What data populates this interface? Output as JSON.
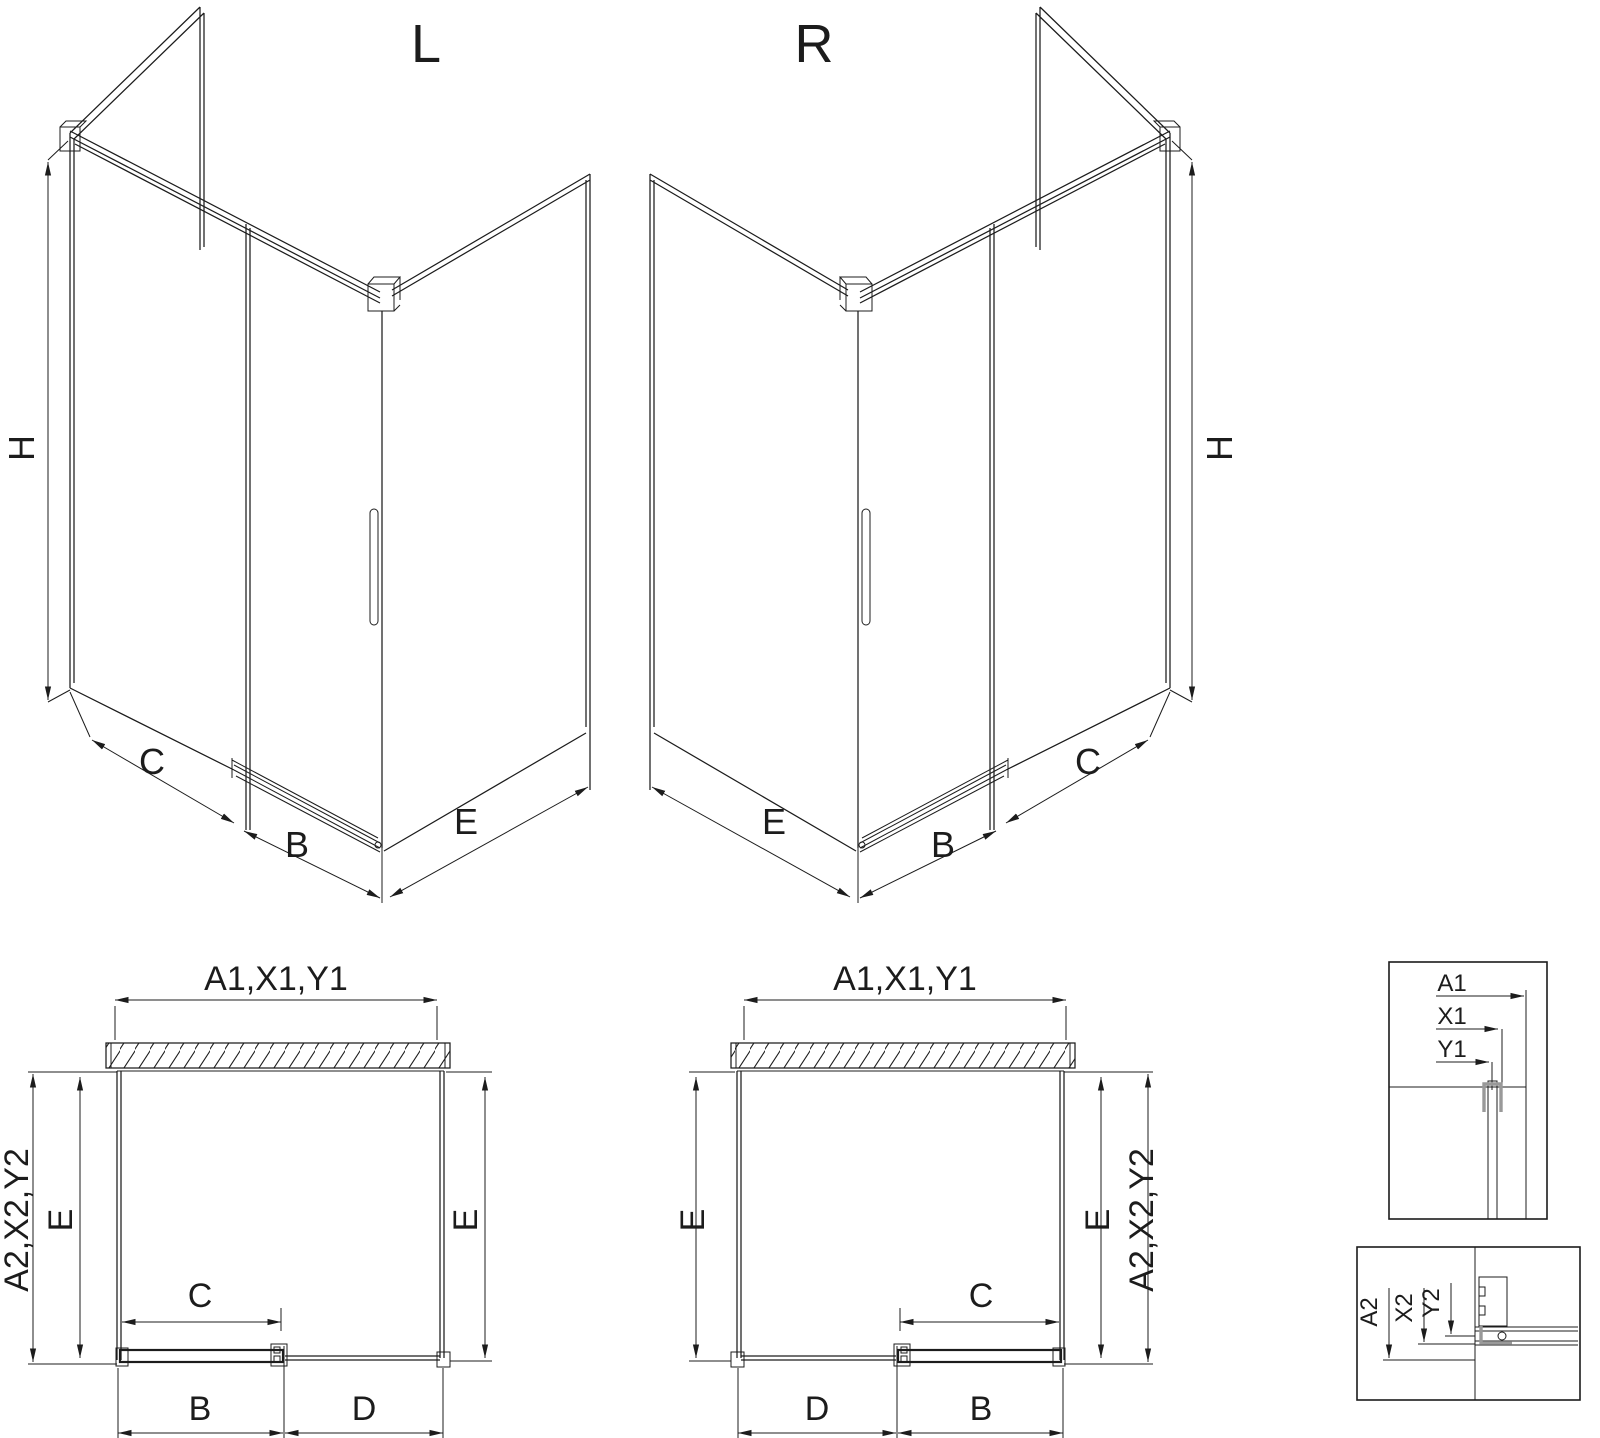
{
  "drawing_type": "shower-enclosure-technical-drawing",
  "colors": {
    "line": "#1c1c1c",
    "profile_gray": "#999999",
    "background": "#ffffff"
  },
  "views": {
    "iso_left": {
      "title": "L",
      "dim_height": "H",
      "dim_fixed_panel": "C",
      "dim_door": "B",
      "dim_side_panel": "E"
    },
    "iso_right": {
      "title": "R",
      "dim_height": "H",
      "dim_fixed_panel": "C",
      "dim_door": "B",
      "dim_side_panel": "E"
    },
    "plan_left": {
      "dim_top_width": "A1,X1,Y1",
      "dim_left_outer": "A2,X2,Y2",
      "dim_left_depth": "E",
      "dim_right_depth": "E",
      "dim_door_panel": "C",
      "dim_bottom_left": "B",
      "dim_bottom_right": "D"
    },
    "plan_right": {
      "dim_top_width": "A1,X1,Y1",
      "dim_right_outer": "A2,X2,Y2",
      "dim_left_depth": "E",
      "dim_right_depth": "E",
      "dim_door_panel": "C",
      "dim_bottom_left": "D",
      "dim_bottom_right": "B"
    },
    "detail_wall_profile": {
      "dim_1": "A1",
      "dim_2": "X1",
      "dim_3": "Y1"
    },
    "detail_floor_profile": {
      "dim_1": "A2",
      "dim_2": "X2",
      "dim_3": "Y2"
    }
  }
}
